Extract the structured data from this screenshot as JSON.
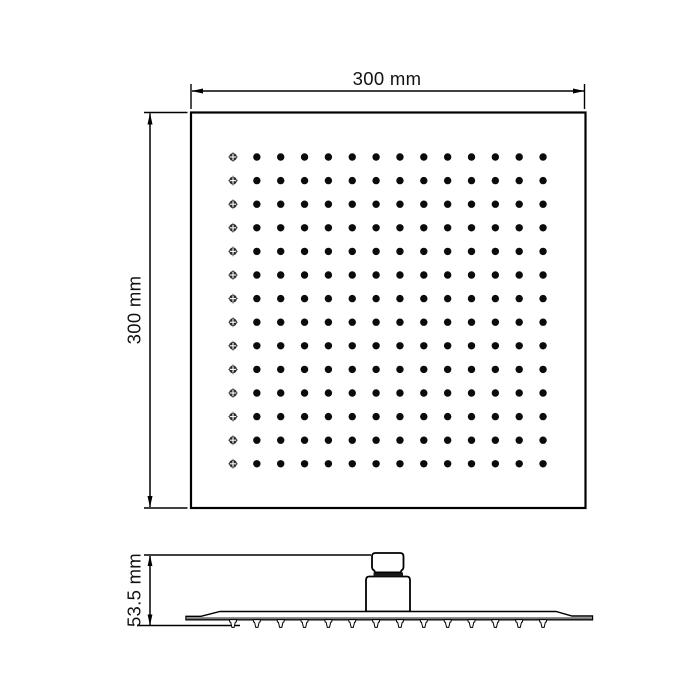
{
  "colors": {
    "background": "#ffffff",
    "line": "#000000",
    "hole": "#0b0b0b",
    "crosshair": "#2e2e2e"
  },
  "top_view": {
    "shape": "square-shower-head-face",
    "width_dimension": {
      "label": "300 mm"
    },
    "height_dimension": {
      "label": "300 mm"
    },
    "spray_hole_grid": {
      "rows": 14,
      "cols": 14,
      "first_column_marker": "crosshair-hole",
      "marker": "solid-hole"
    }
  },
  "side_view": {
    "shape": "slim-plate-profile-with-connector",
    "height_dimension": {
      "label": "53.5 mm"
    },
    "nozzle_count": 14
  }
}
